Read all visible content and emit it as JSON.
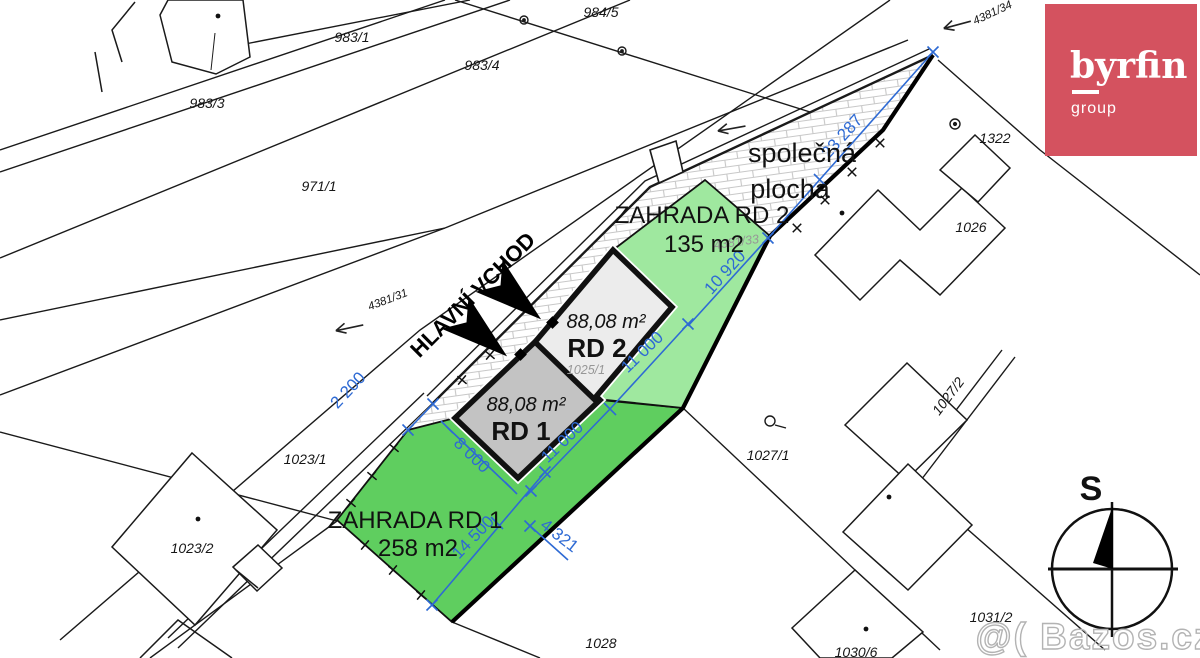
{
  "plan": {
    "common_area_line1": "společná",
    "common_area_line2": "plocha",
    "garden2_name": "ZAHRADA RD 2",
    "garden2_area": "135 m2",
    "garden1_name": "ZAHRADA RD 1",
    "garden1_area": "258 m2",
    "house1_area": "88,08 m²",
    "house1_name": "RD 1",
    "house2_area": "88,08 m²",
    "house2_name": "RD 2",
    "entrance_label": "HLAVNÍ VCHOD"
  },
  "parcels": {
    "p983_1": "983/1",
    "p983_3": "983/3",
    "p983_4": "983/4",
    "p984_5": "984/5",
    "p971_1": "971/1",
    "p1023_1": "1023/1",
    "p1023_2": "1023/2",
    "p1025_1": "1025/1",
    "p1026": "1026",
    "p1027_1": "1027/1",
    "p1027_2": "1027/2",
    "p1028": "1028",
    "p1030_6": "1030/6",
    "p1031_2": "1031/2",
    "p1322": "1322",
    "p4381_31": "4381/31",
    "p4381_33": "4381/33",
    "p4381_34": "4381/34"
  },
  "dimensions": {
    "d2200": "2 200",
    "d8000": "8 000",
    "d11000_rd1": "11 000",
    "d11000_rd2": "11 000",
    "d14500": "14 500",
    "d4321": "4 321",
    "d10920": "10 920",
    "d23287": "23 287"
  },
  "logo": {
    "brand": "byrfin",
    "subtitle": "group",
    "bg_color": "#d4525f"
  },
  "compass": {
    "north_label": "S"
  },
  "watermark": {
    "text": "@( Bazos.cz"
  },
  "colors": {
    "garden_dark": "#5fce5f",
    "garden_light": "#9fe89f",
    "house1_fill": "#c3c3c3",
    "house2_fill": "#ececec",
    "dimension_blue": "#2e6ad4",
    "line_black": "#1a1a1a",
    "hatch_gray": "#c8c8c8"
  }
}
